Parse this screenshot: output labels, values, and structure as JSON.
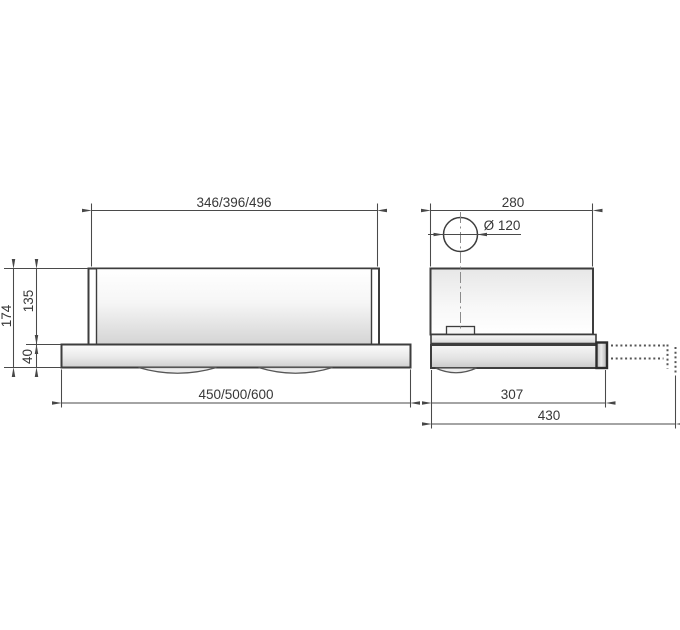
{
  "colors": {
    "outline": "#3d3d3d",
    "dimension_line": "#4a4a4a",
    "label_text": "#383838",
    "phantom_line": "#555555",
    "background": "#ffffff"
  },
  "front_view": {
    "top_width": "346/396/496",
    "bottom_width": "450/500/600",
    "total_height": "174",
    "body_height": "135",
    "visor_height": "40"
  },
  "side_view": {
    "top_depth": "280",
    "duct_diameter": "Ø 120",
    "body_depth": "307",
    "extended_depth": "430"
  }
}
